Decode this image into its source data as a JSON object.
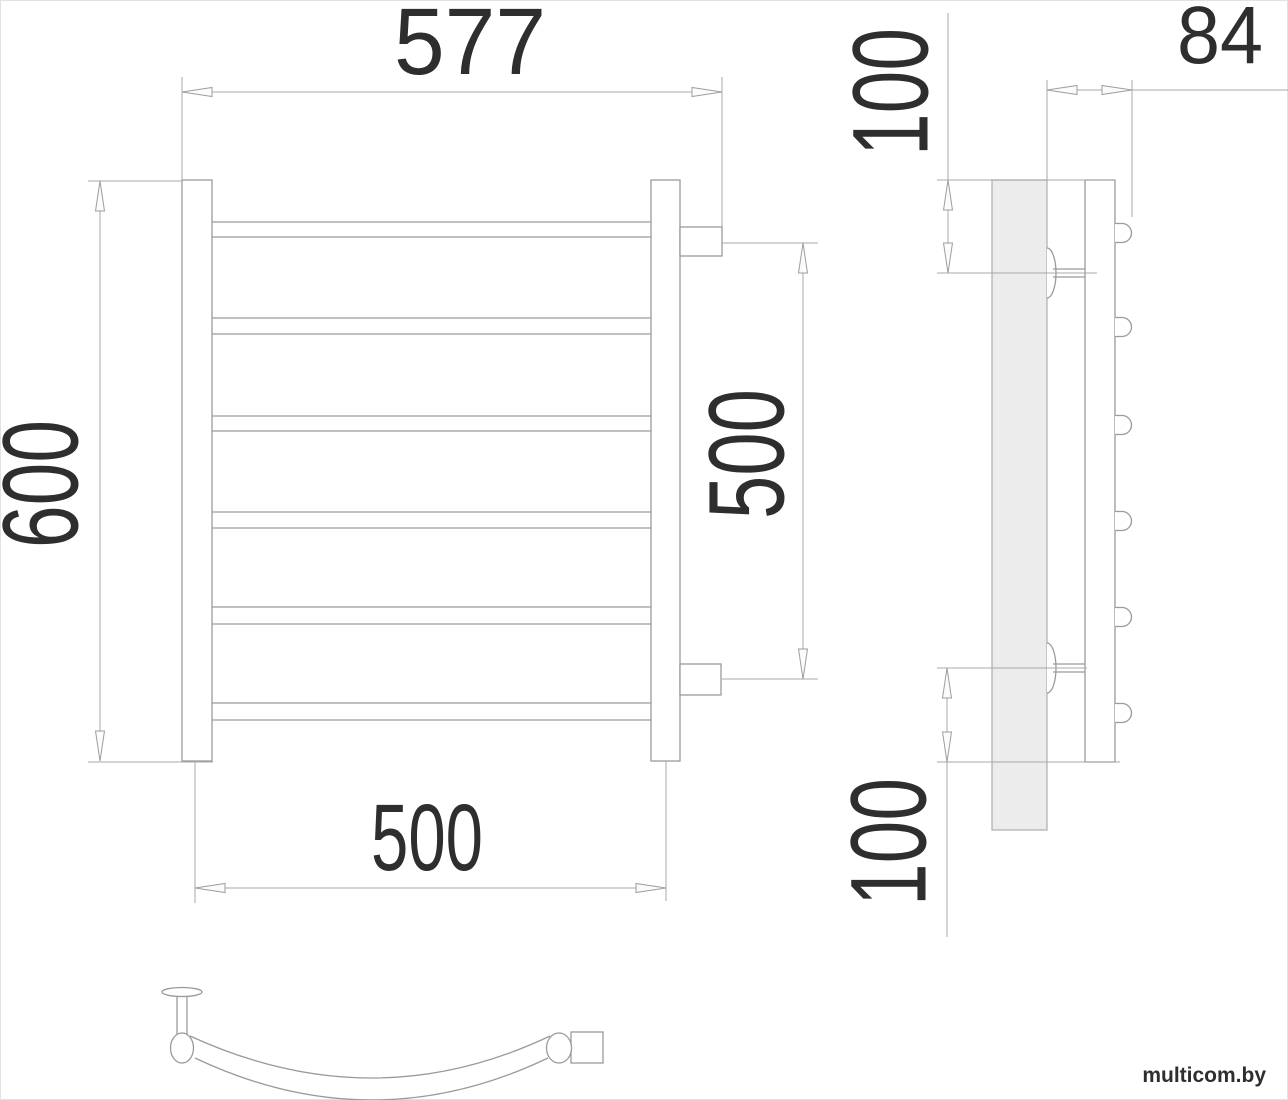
{
  "drawing": {
    "type": "technical-dimension-drawing",
    "subject": "wall-mounted towel rail, three orthographic views",
    "rung_count_front_view": 6,
    "bracket_count_side_view": 2
  },
  "labels": {
    "front_top_width": "577",
    "front_height": "600",
    "connection_spacing_vertical": "500",
    "front_bottom_width": "500",
    "side_depth": "84",
    "side_top_offset": "100",
    "side_bottom_offset": "100"
  },
  "watermark": "multicom.by",
  "colors": {
    "background": "#ffffff",
    "object_line": "#9a9a9a",
    "dimension_line": "#a8a8a8",
    "wall_plate_fill": "#ececec",
    "label_text": "#2e2e2e",
    "watermark_text": "#d6d6d6",
    "page_border": "#e2e2e2"
  }
}
